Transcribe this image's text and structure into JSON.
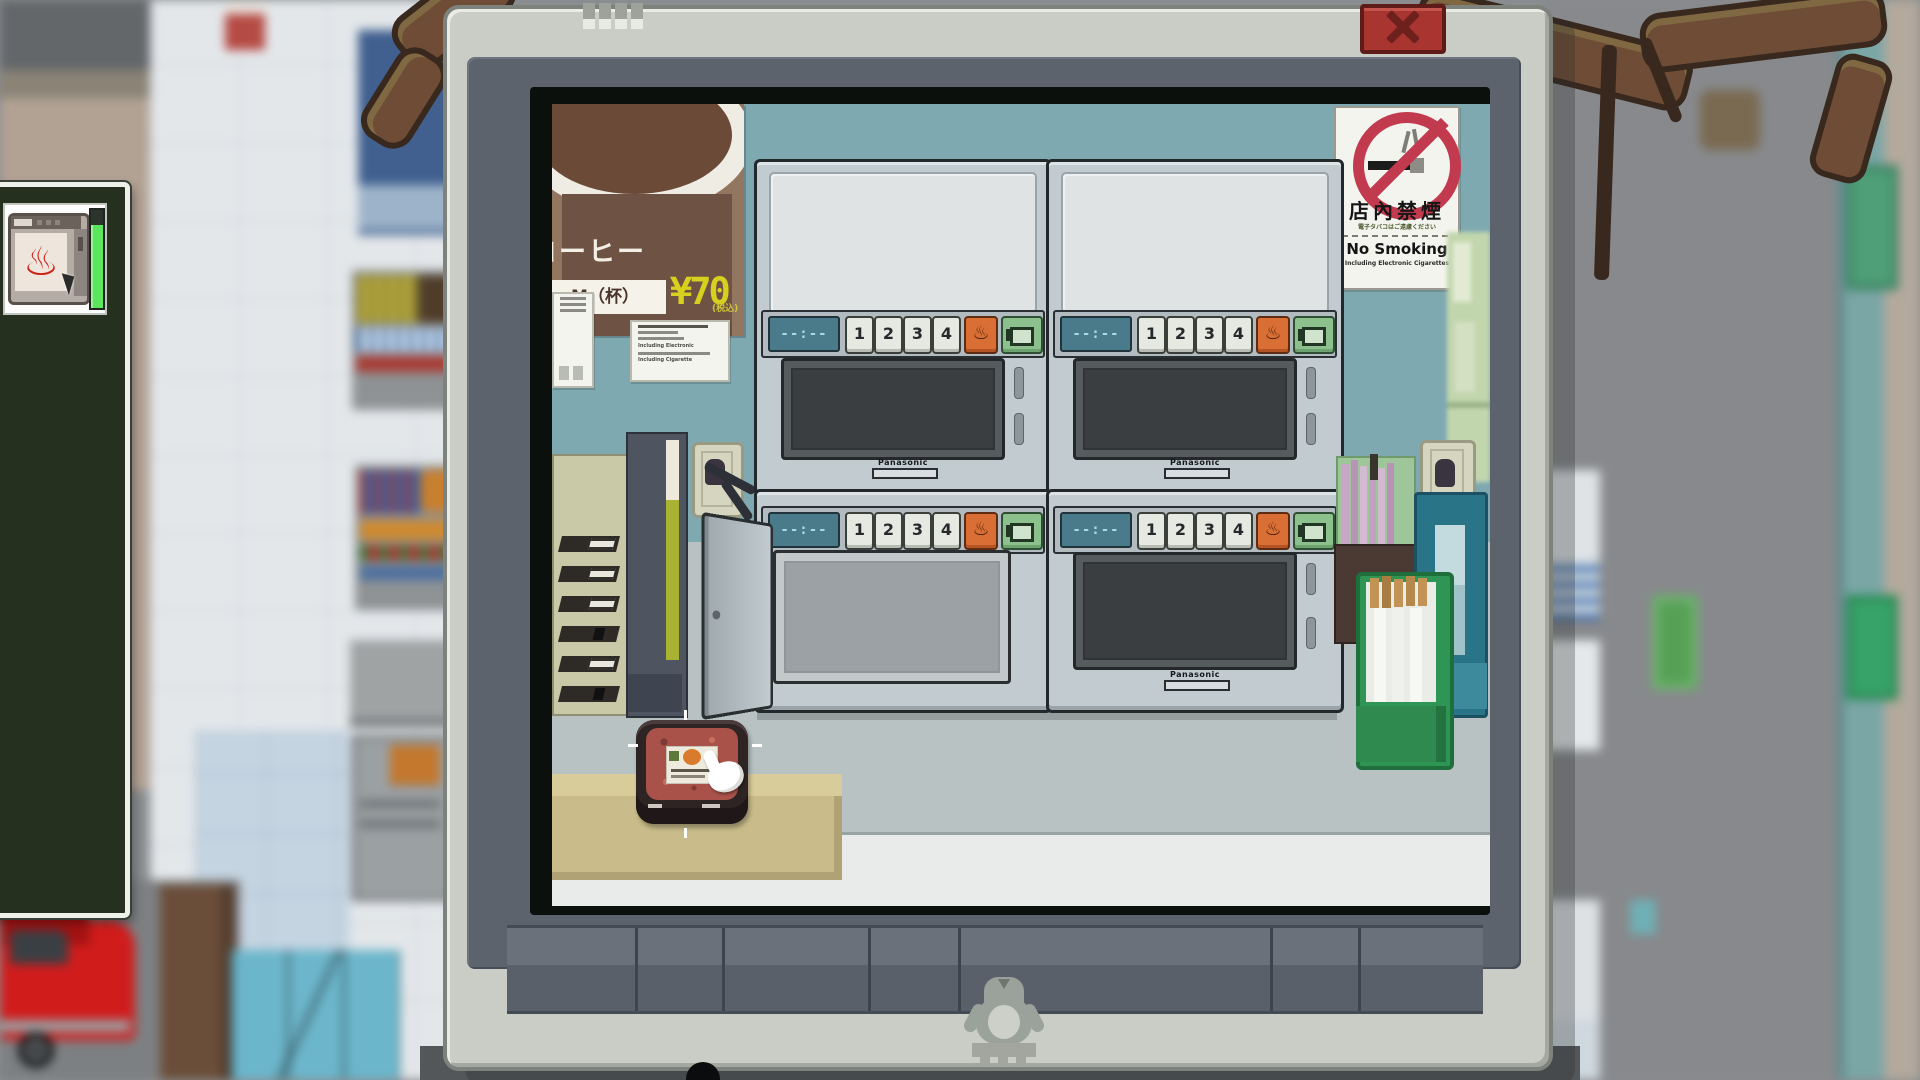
{
  "window": {
    "close_icon": "x-close",
    "brand_logo": "penguin-logo"
  },
  "hud": {
    "item": "microwave-task",
    "icon_glyph": "♨",
    "progress_color": "#5ce65e"
  },
  "scene": {
    "poster": {
      "title": "コーヒー",
      "size": "M（杯）",
      "price": "¥70",
      "tax": "(税込)"
    },
    "notice": {
      "line_en1": "Including Electronic",
      "line_en2": "Including Cigarette"
    },
    "no_smoking": {
      "kanji": "店內禁煙",
      "sub": "電子タバコはご遠慮ください",
      "en": "No Smoking",
      "en_sub": "Including Electronic Cigarettes"
    },
    "microwave": {
      "brand": "Panasonic",
      "display": "--:--",
      "buttons": [
        "1",
        "2",
        "3",
        "4"
      ],
      "heat_glyph": "♨"
    }
  },
  "colors": {
    "modal_bezel": "#c9cdc6",
    "modal_slate": "#5c636d",
    "scene_wall_teal": "#7fa9b1",
    "scene_wall_gray": "#b8c2c2",
    "close_red": "#a93530",
    "button_orange": "#d96f35",
    "button_green": "#8cc08c",
    "display_teal": "#4a7b8a",
    "no_smoking_red": "#c13a4d",
    "progress_green": "#5ce65e",
    "price_yellow": "#d8d01f"
  }
}
